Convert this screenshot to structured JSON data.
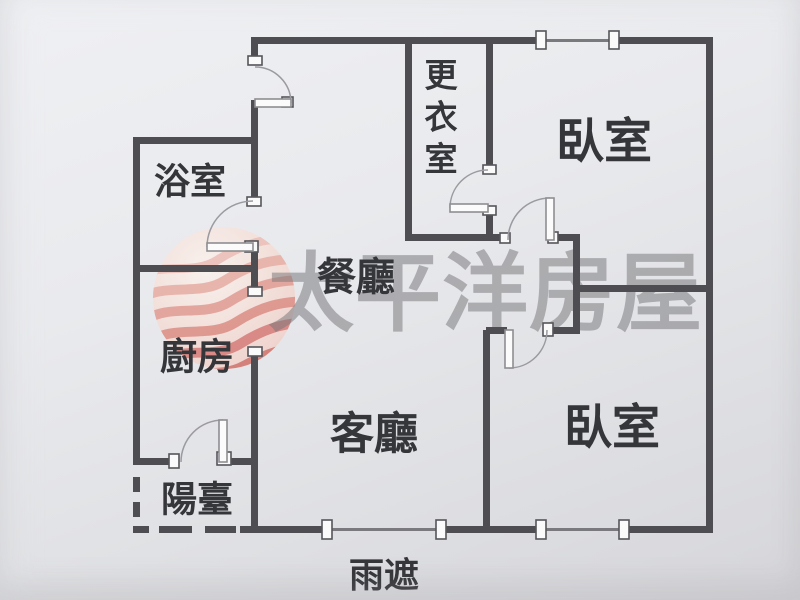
{
  "watermark": {
    "text": "太平洋房屋",
    "text_color": "rgba(118,118,122,0.52)",
    "logo_colors": [
      "#eeb9b0",
      "#e8a79c",
      "#e29489",
      "#dc8378",
      "#d6716a",
      "#d0655e"
    ],
    "logo_bg": "#f9efe9"
  },
  "rooms": [
    {
      "id": "bathroom",
      "label": "浴室",
      "x": 190,
      "y": 181,
      "size": 36
    },
    {
      "id": "walk-in-closet",
      "label": "更衣室",
      "x": 441,
      "y": 75,
      "size": 33,
      "vertical": true
    },
    {
      "id": "bedroom-top",
      "label": "臥室",
      "x": 604,
      "y": 142,
      "size": 48
    },
    {
      "id": "dining-room",
      "label": "餐廳",
      "x": 356,
      "y": 278,
      "size": 39
    },
    {
      "id": "kitchen",
      "label": "廚房",
      "x": 197,
      "y": 357,
      "size": 37
    },
    {
      "id": "living-room",
      "label": "客廳",
      "x": 374,
      "y": 434,
      "size": 44
    },
    {
      "id": "bedroom-bottom",
      "label": "臥室",
      "x": 612,
      "y": 428,
      "size": 48
    },
    {
      "id": "balcony",
      "label": "陽臺",
      "x": 197,
      "y": 499,
      "size": 36
    },
    {
      "id": "rain-canopy",
      "label": "雨遮",
      "x": 384,
      "y": 576,
      "size": 35
    }
  ],
  "plan": {
    "wall_color": "#4d4d52",
    "thin_color": "#7a7a7e",
    "arc_color": "#9a9aa0",
    "leaf_fill": "#fbfbfc",
    "leaf_stroke": "#8e8e92",
    "bracket_fill": "#fafafb",
    "bracket_stroke": "#55555a",
    "label_color": "#35363a",
    "walls": [
      [
        254,
        37,
        290,
        7
      ],
      [
        619,
        37,
        94,
        7
      ],
      [
        706,
        37,
        7,
        496
      ],
      [
        250,
        526,
        74,
        7
      ],
      [
        444,
        526,
        94,
        7
      ],
      [
        627,
        526,
        86,
        7
      ],
      [
        133,
        137,
        7,
        328
      ],
      [
        133,
        137,
        125,
        7
      ],
      [
        133,
        265,
        125,
        7
      ],
      [
        251,
        37,
        7,
        27
      ],
      [
        251,
        100,
        7,
        106
      ],
      [
        251,
        244,
        7,
        46
      ],
      [
        251,
        354,
        7,
        179
      ],
      [
        133,
        458,
        39,
        7
      ],
      [
        229,
        458,
        29,
        7
      ],
      [
        405,
        37,
        7,
        204
      ],
      [
        486,
        37,
        7,
        137
      ],
      [
        486,
        212,
        7,
        29
      ],
      [
        405,
        234,
        102,
        7
      ],
      [
        554,
        234,
        26,
        7
      ],
      [
        573,
        234,
        7,
        100
      ],
      [
        580,
        285,
        133,
        7
      ],
      [
        486,
        327,
        21,
        7
      ],
      [
        551,
        327,
        29,
        7
      ],
      [
        483,
        330,
        7,
        203
      ]
    ],
    "dashes": [
      [
        133,
        477,
        7,
        15
      ],
      [
        133,
        502,
        7,
        15
      ],
      [
        133,
        526,
        16,
        7
      ],
      [
        159,
        526,
        33,
        7
      ],
      [
        205,
        526,
        31,
        7
      ],
      [
        240,
        526,
        10,
        7
      ]
    ],
    "window_lines": [
      [
        545,
        39,
        65,
        3
      ],
      [
        331,
        528,
        106,
        3
      ],
      [
        546,
        528,
        74,
        3
      ]
    ],
    "window_brackets": [
      [
        536,
        31,
        10,
        18
      ],
      [
        609,
        31,
        10,
        18
      ],
      [
        322,
        520,
        10,
        19
      ],
      [
        436,
        520,
        10,
        19
      ],
      [
        536,
        520,
        10,
        19
      ],
      [
        619,
        520,
        10,
        19
      ]
    ],
    "jambs": [
      [
        248,
        56,
        14,
        9
      ],
      [
        282,
        97,
        11,
        10
      ],
      [
        247,
        197,
        14,
        9
      ],
      [
        245,
        241,
        13,
        11
      ],
      [
        248,
        287,
        14,
        9
      ],
      [
        248,
        347,
        14,
        9
      ],
      [
        169,
        454,
        10,
        14
      ],
      [
        217,
        452,
        14,
        13
      ],
      [
        483,
        165,
        13,
        9
      ],
      [
        483,
        206,
        13,
        9
      ],
      [
        500,
        233,
        10,
        10
      ],
      [
        548,
        232,
        10,
        11
      ],
      [
        543,
        323,
        10,
        13
      ]
    ],
    "doors": [
      {
        "id": "entry-door",
        "leaf": [
          255,
          99,
          36,
          8
        ],
        "arc": "M 291 103 A 36 36 0 0 0 255 67"
      },
      {
        "id": "bathroom-door",
        "leaf": [
          207,
          243,
          46,
          8
        ],
        "arc": "M 207 247 A 46 46 0 0 1 253 201"
      },
      {
        "id": "closet-door",
        "leaf": [
          450,
          204,
          38,
          8
        ],
        "arc": "M 450 208 A 38 38 0 0 1 488 170"
      },
      {
        "id": "bedroom-top-door",
        "leaf": [
          546,
          198,
          8,
          42
        ],
        "arc": "M 550 198 A 42 42 0 0 0 508 240"
      },
      {
        "id": "bedroom-bottom-door",
        "leaf": [
          505,
          330,
          8,
          38
        ],
        "arc": "M 509 368 A 38 38 0 0 0 547 330"
      },
      {
        "id": "balcony-door",
        "leaf": [
          219,
          420,
          8,
          42
        ],
        "arc": "M 223 420 A 42 42 0 0 0 181 462"
      }
    ]
  }
}
